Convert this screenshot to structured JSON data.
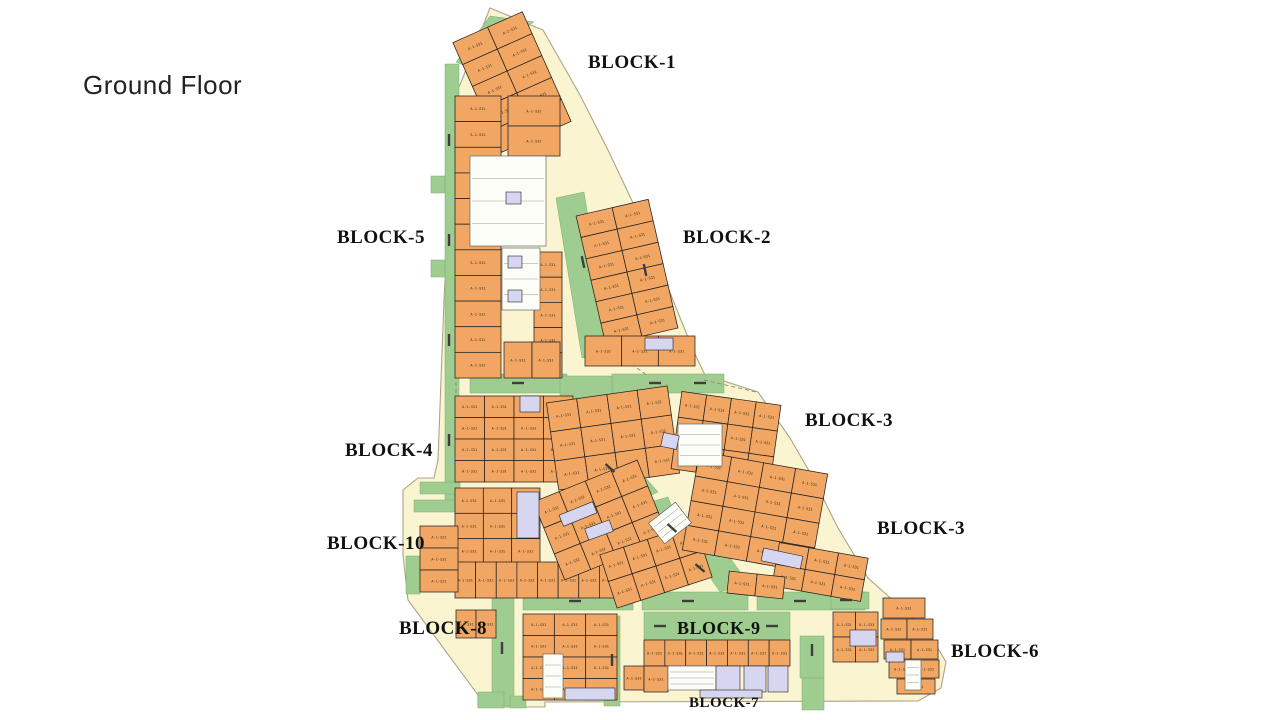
{
  "page": {
    "title": "Ground Floor"
  },
  "palette": {
    "background": "#ffffff",
    "site": "#FAF4D0",
    "site_stroke": "#ABA488",
    "green": "#9FCC8F",
    "green_stroke": "#7FAE72",
    "unit": "#F1A664",
    "unit_stroke": "#222222",
    "special": "#D7D6F0",
    "core": "#FDFDF8",
    "core_stroke": "#666666",
    "dash": "#3E3E3E",
    "label": "#111111",
    "title_color": "#222222"
  },
  "plan": {
    "unit_label": "A-1-S31",
    "site_outline": [
      [
        490,
        8
      ],
      [
        543,
        30
      ],
      [
        580,
        95
      ],
      [
        608,
        150
      ],
      [
        634,
        205
      ],
      [
        655,
        255
      ],
      [
        675,
        305
      ],
      [
        693,
        350
      ],
      [
        705,
        375
      ],
      [
        758,
        392
      ],
      [
        790,
        438
      ],
      [
        812,
        476
      ],
      [
        838,
        528
      ],
      [
        868,
        578
      ],
      [
        906,
        612
      ],
      [
        933,
        640
      ],
      [
        946,
        662
      ],
      [
        941,
        688
      ],
      [
        918,
        701
      ],
      [
        545,
        702
      ],
      [
        545,
        707
      ],
      [
        478,
        707
      ],
      [
        478,
        695
      ],
      [
        408,
        600
      ],
      [
        403,
        555
      ],
      [
        403,
        490
      ],
      [
        418,
        478
      ],
      [
        434,
        478
      ],
      [
        438,
        460
      ],
      [
        444,
        300
      ],
      [
        450,
        180
      ],
      [
        452,
        95
      ],
      [
        460,
        85
      ]
    ],
    "greens": [
      {
        "poly": [
          [
            456,
            62
          ],
          [
            490,
            16
          ],
          [
            534,
            22
          ],
          [
            466,
            66
          ]
        ]
      },
      {
        "rect": [
          445,
          64,
          14,
          440
        ]
      },
      {
        "rect": [
          431,
          176,
          14,
          17
        ]
      },
      {
        "rect": [
          431,
          260,
          14,
          17
        ]
      },
      {
        "poly": [
          [
            556,
            198
          ],
          [
            584,
            192
          ],
          [
            610,
            352
          ],
          [
            582,
            358
          ]
        ]
      },
      {
        "poly": [
          [
            613,
            216
          ],
          [
            637,
            211
          ],
          [
            660,
            330
          ],
          [
            636,
            336
          ]
        ]
      },
      {
        "rect": [
          470,
          374,
          97,
          19
        ]
      },
      {
        "rect": [
          612,
          374,
          112,
          19
        ]
      },
      {
        "poly": [
          [
            560,
            376
          ],
          [
            612,
            376
          ],
          [
            612,
            400
          ],
          [
            588,
            426
          ],
          [
            560,
            422
          ]
        ]
      },
      {
        "poly": [
          [
            560,
            424
          ],
          [
            592,
            417
          ],
          [
            658,
            492
          ],
          [
            628,
            506
          ]
        ]
      },
      {
        "poly": [
          [
            640,
            505
          ],
          [
            668,
            497
          ],
          [
            690,
            552
          ],
          [
            662,
            562
          ]
        ]
      },
      {
        "poly": [
          [
            688,
            545
          ],
          [
            716,
            538
          ],
          [
            748,
            583
          ],
          [
            720,
            592
          ]
        ]
      },
      {
        "rect": [
          523,
          592,
          110,
          18
        ]
      },
      {
        "rect": [
          642,
          592,
          106,
          18
        ]
      },
      {
        "rect": [
          757,
          592,
          108,
          18
        ]
      },
      {
        "rect": [
          644,
          612,
          146,
          28
        ]
      },
      {
        "rect": [
          492,
          594,
          22,
          112
        ]
      },
      {
        "rect": [
          604,
          616,
          16,
          90
        ]
      },
      {
        "rect": [
          800,
          636,
          24,
          42
        ]
      },
      {
        "rect": [
          802,
          678,
          22,
          32
        ]
      },
      {
        "rect": [
          478,
          692,
          26,
          16
        ]
      },
      {
        "rect": [
          510,
          696,
          16,
          12
        ]
      },
      {
        "rect": [
          414,
          500,
          46,
          12
        ]
      },
      {
        "rect": [
          406,
          556,
          14,
          38
        ]
      },
      {
        "rect": [
          420,
          482,
          40,
          12
        ]
      },
      {
        "rect": [
          831,
          592,
          38,
          17
        ]
      }
    ],
    "clusters": [
      {
        "x": 474,
        "y": 22,
        "w": 76,
        "h": 120,
        "rows": 5,
        "cols": 2,
        "rot": -24
      },
      {
        "x": 455,
        "y": 96,
        "w": 46,
        "h": 282,
        "rows": 11,
        "cols": 1,
        "rot": 0
      },
      {
        "x": 508,
        "y": 96,
        "w": 52,
        "h": 60,
        "rows": 2,
        "cols": 1,
        "rot": 0
      },
      {
        "x": 534,
        "y": 252,
        "w": 28,
        "h": 126,
        "rows": 5,
        "cols": 1,
        "rot": 0
      },
      {
        "x": 504,
        "y": 342,
        "w": 56,
        "h": 36,
        "rows": 1,
        "cols": 2,
        "rot": 0
      },
      {
        "x": 590,
        "y": 206,
        "w": 74,
        "h": 132,
        "rows": 6,
        "cols": 2,
        "rot": -13
      },
      {
        "x": 585,
        "y": 336,
        "w": 110,
        "h": 30,
        "rows": 1,
        "cols": 3,
        "rot": 0
      },
      {
        "x": 455,
        "y": 396,
        "w": 118,
        "h": 86,
        "rows": 4,
        "cols": 4,
        "rot": 0
      },
      {
        "x": 552,
        "y": 394,
        "w": 122,
        "h": 88,
        "rows": 3,
        "cols": 4,
        "rot": -8
      },
      {
        "x": 676,
        "y": 398,
        "w": 100,
        "h": 78,
        "rows": 3,
        "cols": 4,
        "rot": 8
      },
      {
        "x": 455,
        "y": 488,
        "w": 85,
        "h": 76,
        "rows": 3,
        "cols": 3,
        "rot": 0
      },
      {
        "x": 455,
        "y": 562,
        "w": 165,
        "h": 36,
        "rows": 1,
        "cols": 8,
        "rot": 0
      },
      {
        "x": 545,
        "y": 478,
        "w": 112,
        "h": 84,
        "rows": 3,
        "cols": 4,
        "rot": -22
      },
      {
        "x": 606,
        "y": 538,
        "w": 100,
        "h": 56,
        "rows": 2,
        "cols": 4,
        "rot": -18
      },
      {
        "x": 690,
        "y": 462,
        "w": 130,
        "h": 100,
        "rows": 4,
        "cols": 4,
        "rot": 10
      },
      {
        "x": 775,
        "y": 550,
        "w": 90,
        "h": 44,
        "rows": 2,
        "cols": 3,
        "rot": 10
      },
      {
        "x": 728,
        "y": 574,
        "w": 56,
        "h": 22,
        "rows": 1,
        "cols": 2,
        "rot": 6
      },
      {
        "x": 420,
        "y": 526,
        "w": 38,
        "h": 66,
        "rows": 3,
        "cols": 1,
        "rot": 0
      },
      {
        "x": 456,
        "y": 610,
        "w": 40,
        "h": 28,
        "rows": 1,
        "cols": 2,
        "rot": 0
      },
      {
        "x": 523,
        "y": 614,
        "w": 94,
        "h": 86,
        "rows": 4,
        "cols": 3,
        "rot": 0
      },
      {
        "x": 644,
        "y": 640,
        "w": 146,
        "h": 26,
        "rows": 1,
        "cols": 7,
        "rot": 0
      },
      {
        "x": 624,
        "y": 666,
        "w": 20,
        "h": 24,
        "rows": 1,
        "cols": 1,
        "rot": 0
      },
      {
        "x": 644,
        "y": 666,
        "w": 24,
        "h": 26,
        "rows": 1,
        "cols": 1,
        "rot": 0
      },
      {
        "x": 833,
        "y": 612,
        "w": 45,
        "h": 50,
        "rows": 2,
        "cols": 2,
        "rot": 0
      },
      {
        "x": 883,
        "y": 598,
        "w": 42,
        "h": 20,
        "rows": 1,
        "cols": 1,
        "rot": 0
      },
      {
        "x": 881,
        "y": 619,
        "w": 52,
        "h": 20,
        "rows": 1,
        "cols": 2,
        "rot": 0
      },
      {
        "x": 884,
        "y": 640,
        "w": 54,
        "h": 19,
        "rows": 1,
        "cols": 2,
        "rot": 0
      },
      {
        "x": 889,
        "y": 660,
        "w": 50,
        "h": 18,
        "rows": 1,
        "cols": 2,
        "rot": 0
      },
      {
        "x": 897,
        "y": 679,
        "w": 38,
        "h": 15,
        "rows": 1,
        "cols": 1,
        "rot": 0
      }
    ],
    "cores": [
      {
        "rect": [
          470,
          156,
          76,
          90
        ],
        "rot": 0
      },
      {
        "rect": [
          502,
          248,
          38,
          62
        ],
        "rot": 0
      },
      {
        "rect": [
          678,
          424,
          44,
          42
        ],
        "rot": 0
      },
      {
        "rect": [
          653,
          510,
          34,
          26
        ],
        "rot": -38
      },
      {
        "rect": [
          543,
          654,
          20,
          44
        ],
        "rot": 0
      },
      {
        "rect": [
          668,
          666,
          48,
          24
        ],
        "rot": 0
      },
      {
        "rect": [
          905,
          660,
          16,
          30
        ],
        "rot": 0
      }
    ],
    "specials": [
      {
        "rect": [
          506,
          192,
          15,
          12
        ],
        "rot": 0
      },
      {
        "rect": [
          508,
          256,
          14,
          12
        ],
        "rot": 0
      },
      {
        "rect": [
          508,
          290,
          14,
          12
        ],
        "rot": 0
      },
      {
        "rect": [
          645,
          338,
          28,
          12
        ],
        "rot": 0
      },
      {
        "rect": [
          662,
          434,
          16,
          14
        ],
        "rot": 12
      },
      {
        "rect": [
          517,
          492,
          22,
          46
        ],
        "rot": 0
      },
      {
        "rect": [
          520,
          396,
          20,
          16
        ],
        "rot": 0
      },
      {
        "rect": [
          560,
          508,
          36,
          12
        ],
        "rot": -22
      },
      {
        "rect": [
          586,
          524,
          26,
          12
        ],
        "rot": -20
      },
      {
        "rect": [
          762,
          552,
          40,
          13
        ],
        "rot": 12
      },
      {
        "rect": [
          565,
          688,
          50,
          12
        ],
        "rot": 0
      },
      {
        "rect": [
          716,
          666,
          24,
          26
        ],
        "rot": 0
      },
      {
        "rect": [
          744,
          666,
          22,
          26
        ],
        "rot": 0
      },
      {
        "rect": [
          768,
          666,
          20,
          26
        ],
        "rot": 0
      },
      {
        "rect": [
          700,
          690,
          62,
          8
        ],
        "rot": 0
      },
      {
        "rect": [
          850,
          630,
          26,
          16
        ],
        "rot": 0
      },
      {
        "rect": [
          886,
          652,
          18,
          10
        ],
        "rot": 0
      }
    ],
    "green_dashes": [
      [
        449,
        140,
        90
      ],
      [
        449,
        240,
        90
      ],
      [
        449,
        340,
        90
      ],
      [
        449,
        440,
        90
      ],
      [
        583,
        262,
        78
      ],
      [
        645,
        270,
        78
      ],
      [
        518,
        383,
        0
      ],
      [
        655,
        383,
        0
      ],
      [
        700,
        383,
        0
      ],
      [
        610,
        468,
        42
      ],
      [
        672,
        528,
        42
      ],
      [
        700,
        568,
        40
      ],
      [
        575,
        601,
        0
      ],
      [
        688,
        601,
        0
      ],
      [
        800,
        601,
        0
      ],
      [
        502,
        648,
        90
      ],
      [
        612,
        660,
        90
      ],
      [
        812,
        650,
        90
      ],
      [
        846,
        600,
        0
      ],
      [
        660,
        626,
        0
      ],
      [
        772,
        626,
        0
      ]
    ],
    "dashed_lines": [
      [
        [
          456,
          382
        ],
        [
          456,
          468
        ]
      ],
      [
        [
          543,
          614
        ],
        [
          543,
          700
        ]
      ],
      [
        [
          704,
          380
        ],
        [
          756,
          392
        ]
      ],
      [
        [
          620,
          356
        ],
        [
          648,
          376
        ]
      ]
    ]
  },
  "block_labels": [
    {
      "text": "BLOCK-1",
      "x": 588,
      "y": 68,
      "size": 19
    },
    {
      "text": "BLOCK-5",
      "x": 337,
      "y": 243,
      "size": 19
    },
    {
      "text": "BLOCK-2",
      "x": 683,
      "y": 243,
      "size": 19
    },
    {
      "text": "BLOCK-3",
      "x": 805,
      "y": 426,
      "size": 19
    },
    {
      "text": "BLOCK-4",
      "x": 345,
      "y": 456,
      "size": 19
    },
    {
      "text": "BLOCK-10",
      "x": 327,
      "y": 549,
      "size": 19
    },
    {
      "text": "BLOCK-3",
      "x": 877,
      "y": 534,
      "size": 19
    },
    {
      "text": "BLOCK-8",
      "x": 399,
      "y": 634,
      "size": 19
    },
    {
      "text": "BLOCK-9",
      "x": 677,
      "y": 634,
      "size": 18
    },
    {
      "text": "BLOCK-6",
      "x": 951,
      "y": 657,
      "size": 19
    },
    {
      "text": "BLOCK-7",
      "x": 689,
      "y": 707,
      "size": 15
    }
  ]
}
